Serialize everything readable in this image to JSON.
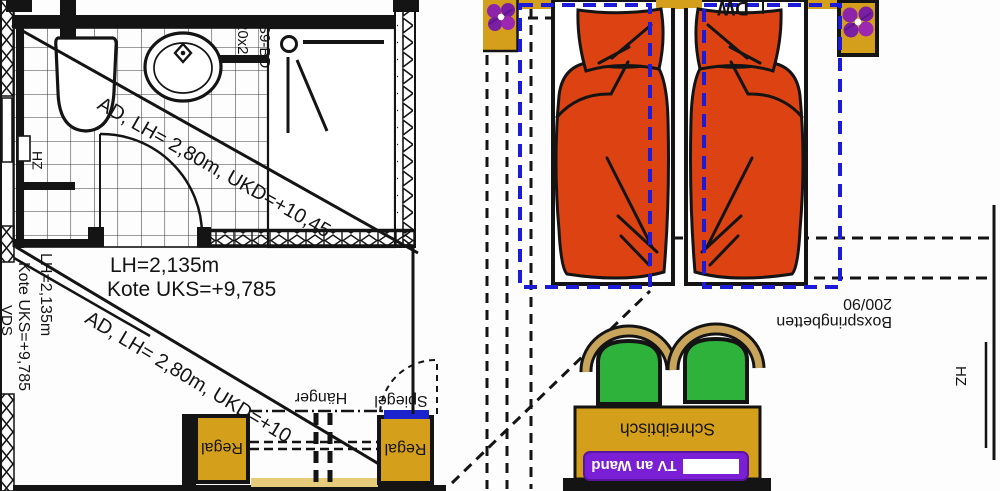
{
  "colors": {
    "wood": "#d49f1a",
    "light_wood": "#e6cb7a",
    "duvet_orange": "#dd4312",
    "chair_green": "#2eb23c",
    "zone_outline_blue": "#1b1bd8",
    "mirror_strip_blue": "#1a23cc",
    "tv_board_purple": "#7b1fd6",
    "symbol_purple": "#9627c8",
    "line_black": "#141414"
  },
  "bathroom": {
    "ceiling_note_upper": "AD, LH= 2,80m, UKD=+10,45",
    "ceiling_note_lower": "AD, LH= 2,80m, UKD=+10",
    "height_note": "LH=2,135m",
    "level_note": "Kote UKS=+9,785",
    "height_note_side": "LH=2,135m",
    "level_note_side": "Kote UKS=+9,785",
    "duct_label": "VDS",
    "radiator_label": "HZ",
    "tile_note": "20x20",
    "fixture_code": "S9-BD"
  },
  "wardrobe": {
    "shelf_left_label": "Regal",
    "shelf_right_label": "Regal",
    "hanger_label": "Hänger",
    "mirror_label": "Spiegel"
  },
  "bedroom": {
    "bed_type_label": "Boxspringbetten",
    "bed_size_label": "200/90",
    "corner_label": "DW",
    "desk_label": "Schreibtisch",
    "tv_label": "TV an Wand",
    "radiator_label": "HZ"
  }
}
